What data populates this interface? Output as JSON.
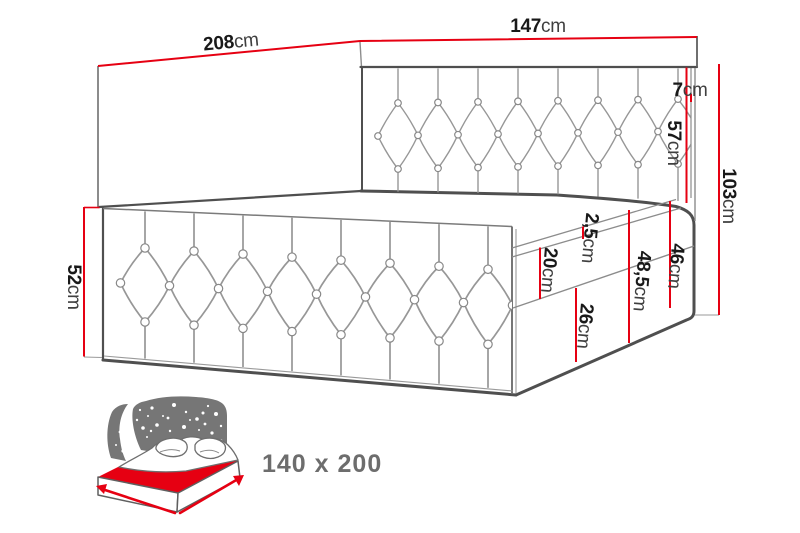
{
  "diagram": {
    "dimensions": {
      "side_length": {
        "value": "208",
        "unit": "cm"
      },
      "headboard_width": {
        "value": "147",
        "unit": "cm"
      },
      "headboard_top_height": {
        "value": "7",
        "unit": "cm"
      },
      "headboard_front_height": {
        "value": "57",
        "unit": "cm"
      },
      "total_height": {
        "value": "103",
        "unit": "cm"
      },
      "front_panel_height": {
        "value": "52",
        "unit": "cm"
      },
      "mattress_lip": {
        "value": "2,5",
        "unit": "cm"
      },
      "upper_section": {
        "value": "20",
        "unit": "cm"
      },
      "lower_section": {
        "value": "26",
        "unit": "cm"
      },
      "side_height_total": {
        "value": "48,5",
        "unit": "cm"
      },
      "box_height": {
        "value": "46",
        "unit": "cm"
      }
    },
    "colors": {
      "dimension": "#e60012",
      "outline": "#4f4f4f",
      "icon": "#767676"
    }
  },
  "size_badge": {
    "label": "140 x 200"
  }
}
